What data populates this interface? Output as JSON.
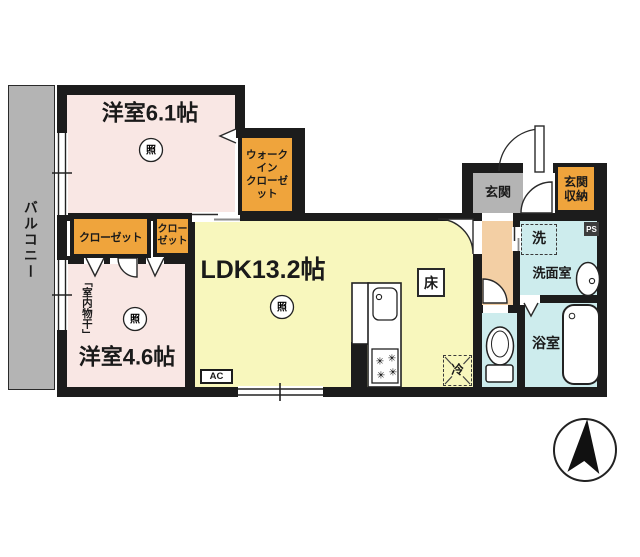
{
  "plan": {
    "bedroom1_label": "洋室6.1帖",
    "bedroom2_label": "洋室4.6帖",
    "ldk_label": "LDK13.2帖",
    "balcony_label": "バルコニー",
    "wic_line1": "ウォークイン",
    "wic_line2": "クローゼット",
    "closet1_label": "クローゼット",
    "closet2_line1": "クロー",
    "closet2_line2": "ゼット",
    "genkan_label": "玄関",
    "genkan_storage_line1": "玄関",
    "genkan_storage_line2": "収納",
    "washroom_label": "洗面室",
    "bathroom_label": "浴室",
    "washer_label": "洗",
    "fridge_label": "冷",
    "floor_hatch_label": "床",
    "ac_label": "AC",
    "ps_label": "PS",
    "light_symbol": "照",
    "indoor_drying_label": "「室内物干」",
    "burner_glyph": "✳",
    "colors": {
      "wall": "#1c1c1c",
      "bedroom_fill": "#f9e7e4",
      "ldk_fill": "#f8f7bd",
      "closet_fill": "#efa43c",
      "hall_fill": "#f3cfa4",
      "wet_room_fill": "#cdeced",
      "gray_fill": "#b4b4b4"
    }
  }
}
